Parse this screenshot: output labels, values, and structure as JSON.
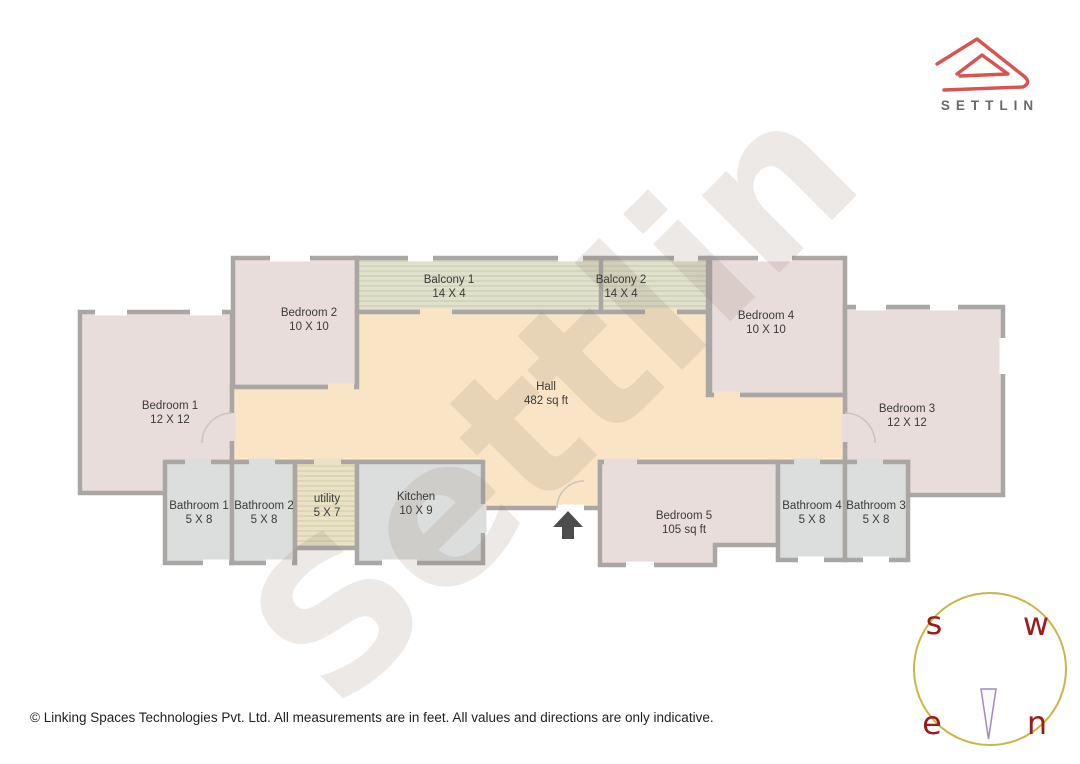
{
  "page": {
    "watermark": "Settlin"
  },
  "logo": {
    "brand": "SETTLIN"
  },
  "footer": {
    "copyright": "© Linking Spaces Technologies Pvt. Ltd. All measurements are in feet. All values and directions are only indicative."
  },
  "compass": {
    "top_left": "s",
    "top_right": "w",
    "bottom_left": "e",
    "bottom_right": "n"
  },
  "floorplan": {
    "rooms": {
      "bedroom1": {
        "name": "Bedroom 1",
        "dims": "12 X 12"
      },
      "bedroom2": {
        "name": "Bedroom 2",
        "dims": "10 X 10"
      },
      "bedroom3": {
        "name": "Bedroom 3",
        "dims": "12 X 12"
      },
      "bedroom4": {
        "name": "Bedroom 4",
        "dims": "10 X 10"
      },
      "bedroom5": {
        "name": "Bedroom 5",
        "dims": "105 sq ft"
      },
      "balcony1": {
        "name": "Balcony 1",
        "dims": "14 X 4"
      },
      "balcony2": {
        "name": "Balcony 2",
        "dims": "14 X 4"
      },
      "hall": {
        "name": "Hall",
        "dims": "482 sq ft"
      },
      "kitchen": {
        "name": "Kitchen",
        "dims": "10 X 9"
      },
      "utility": {
        "name": "utility",
        "dims": "5 X 7"
      },
      "bathroom1": {
        "name": "Bathroom 1",
        "dims": "5 X 8"
      },
      "bathroom2": {
        "name": "Bathroom 2",
        "dims": "5 X 8"
      },
      "bathroom3": {
        "name": "Bathroom 3",
        "dims": "5 X 8"
      },
      "bathroom4": {
        "name": "Bathroom 4",
        "dims": "5 X 8"
      }
    }
  },
  "colors": {
    "wall": "#a9a6a4",
    "bedroom_fill": "#e9dddc",
    "hall_fill": "#f9e5c6",
    "bath_fill": "#dcdede",
    "balcony_fill": "#e0e1cc",
    "utility_fill": "#e9e2c7",
    "logo_red": "#d95450",
    "compass_circle": "#c9b64b",
    "compass_letters": "#9b1b1b",
    "needle_purple": "#a18ac0",
    "entrance_arrow": "#4d4d4d"
  }
}
